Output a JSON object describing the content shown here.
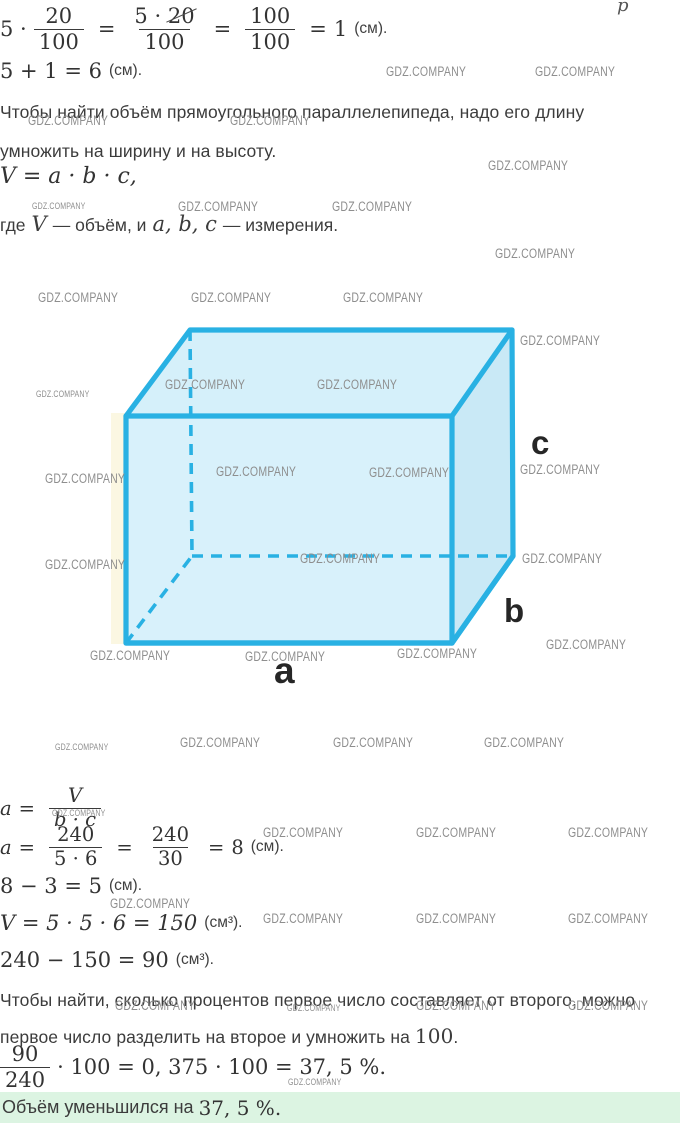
{
  "colors": {
    "cube_stroke": "#29b1e3",
    "cube_front": "#d8f1fb",
    "cube_top": "#d5f0fa",
    "cube_right": "#c9e9f6",
    "answer_bg": "#dcf4e2",
    "watermark": "#8e8e8e"
  },
  "watermark": {
    "label": "GDZ.COMPANY"
  },
  "stray": {
    "label": "p"
  },
  "step1": {
    "factor": "5 ·",
    "frac1": {
      "num": "20",
      "den": "100"
    },
    "eq1": "=",
    "frac2": {
      "num_prefix": "5 ·",
      "num_cancel": "20",
      "den": "100"
    },
    "eq2": "=",
    "frac3": {
      "num": "100",
      "den": "100"
    },
    "eq3": "=",
    "result": "1",
    "unit": "(см)."
  },
  "step2": {
    "expr": "5 + 1 = 6",
    "unit": "(см)."
  },
  "rule_volume": {
    "line1": "Чтобы найти объём прямоугольного параллелепипеда, надо его длину",
    "line2": "умножить на ширину и на высоту."
  },
  "formula": "V = a · b · c,",
  "legend": {
    "t1": "где",
    "v": "V",
    "t2": "— объём, и",
    "vars": "a, b, c",
    "t3": "— измерения."
  },
  "cube": {
    "label_a": "a",
    "label_b": "b",
    "label_c": "c"
  },
  "step3": {
    "lhs": "a",
    "eq": "=",
    "num": "V",
    "den": "b · c"
  },
  "step4": {
    "lhs": "a",
    "eq": "=",
    "frac1": {
      "num": "240",
      "den": "5 · 6"
    },
    "eq2": "=",
    "frac2": {
      "num": "240",
      "den": "30"
    },
    "eq3": "=",
    "result": "8",
    "unit": "(см)."
  },
  "step5": {
    "expr": "8 − 3 = 5",
    "unit": "(см)."
  },
  "step6": {
    "expr": "V = 5 · 5 · 6 = 150",
    "unit": "(см³)."
  },
  "step7": {
    "expr": "240 − 150 = 90",
    "unit": "(см³)."
  },
  "rule_percent": {
    "line1": "Чтобы найти, сколько процентов первое число составляет от второго, можно",
    "line2_text": "первое число разделить на второе и умножить на ",
    "line2_num": "100",
    "line2_dot": "."
  },
  "step8": {
    "frac": {
      "num": "90",
      "den": "240"
    },
    "rest": "· 100 = 0, 375 · 100 = 37, 5 %."
  },
  "answer": {
    "text": "Объём уменьшился на",
    "value": "37, 5 %."
  },
  "watermarks": [
    {
      "x": 386,
      "y": 64,
      "size": "normal"
    },
    {
      "x": 535,
      "y": 64,
      "size": "normal"
    },
    {
      "x": 28,
      "y": 113,
      "size": "normal"
    },
    {
      "x": 230,
      "y": 113,
      "size": "normal"
    },
    {
      "x": 488,
      "y": 158,
      "size": "normal"
    },
    {
      "x": 32,
      "y": 201,
      "size": "small"
    },
    {
      "x": 178,
      "y": 199,
      "size": "normal"
    },
    {
      "x": 332,
      "y": 199,
      "size": "normal"
    },
    {
      "x": 495,
      "y": 246,
      "size": "normal"
    },
    {
      "x": 38,
      "y": 290,
      "size": "normal"
    },
    {
      "x": 191,
      "y": 290,
      "size": "normal"
    },
    {
      "x": 343,
      "y": 290,
      "size": "normal"
    },
    {
      "x": 520,
      "y": 333,
      "size": "normal"
    },
    {
      "x": 165,
      "y": 377,
      "size": "normal"
    },
    {
      "x": 317,
      "y": 377,
      "size": "normal"
    },
    {
      "x": 36,
      "y": 389,
      "size": "small"
    },
    {
      "x": 45,
      "y": 471,
      "size": "normal"
    },
    {
      "x": 216,
      "y": 464,
      "size": "normal"
    },
    {
      "x": 369,
      "y": 465,
      "size": "normal"
    },
    {
      "x": 520,
      "y": 462,
      "size": "normal"
    },
    {
      "x": 300,
      "y": 551,
      "size": "normal"
    },
    {
      "x": 522,
      "y": 551,
      "size": "normal"
    },
    {
      "x": 45,
      "y": 557,
      "size": "normal"
    },
    {
      "x": 546,
      "y": 637,
      "size": "normal"
    },
    {
      "x": 90,
      "y": 648,
      "size": "normal"
    },
    {
      "x": 245,
      "y": 649,
      "size": "normal"
    },
    {
      "x": 397,
      "y": 646,
      "size": "normal"
    },
    {
      "x": 55,
      "y": 742,
      "size": "small"
    },
    {
      "x": 180,
      "y": 735,
      "size": "normal"
    },
    {
      "x": 333,
      "y": 735,
      "size": "normal"
    },
    {
      "x": 484,
      "y": 735,
      "size": "normal"
    },
    {
      "x": 52,
      "y": 808,
      "size": "small"
    },
    {
      "x": 263,
      "y": 825,
      "size": "normal"
    },
    {
      "x": 416,
      "y": 825,
      "size": "normal"
    },
    {
      "x": 568,
      "y": 825,
      "size": "normal"
    },
    {
      "x": 110,
      "y": 896,
      "size": "normal"
    },
    {
      "x": 263,
      "y": 911,
      "size": "normal"
    },
    {
      "x": 416,
      "y": 911,
      "size": "normal"
    },
    {
      "x": 568,
      "y": 911,
      "size": "normal"
    },
    {
      "x": 115,
      "y": 998,
      "size": "normal"
    },
    {
      "x": 287,
      "y": 1003,
      "size": "small"
    },
    {
      "x": 416,
      "y": 998,
      "size": "normal"
    },
    {
      "x": 568,
      "y": 998,
      "size": "normal"
    },
    {
      "x": 288,
      "y": 1077,
      "size": "small"
    }
  ]
}
